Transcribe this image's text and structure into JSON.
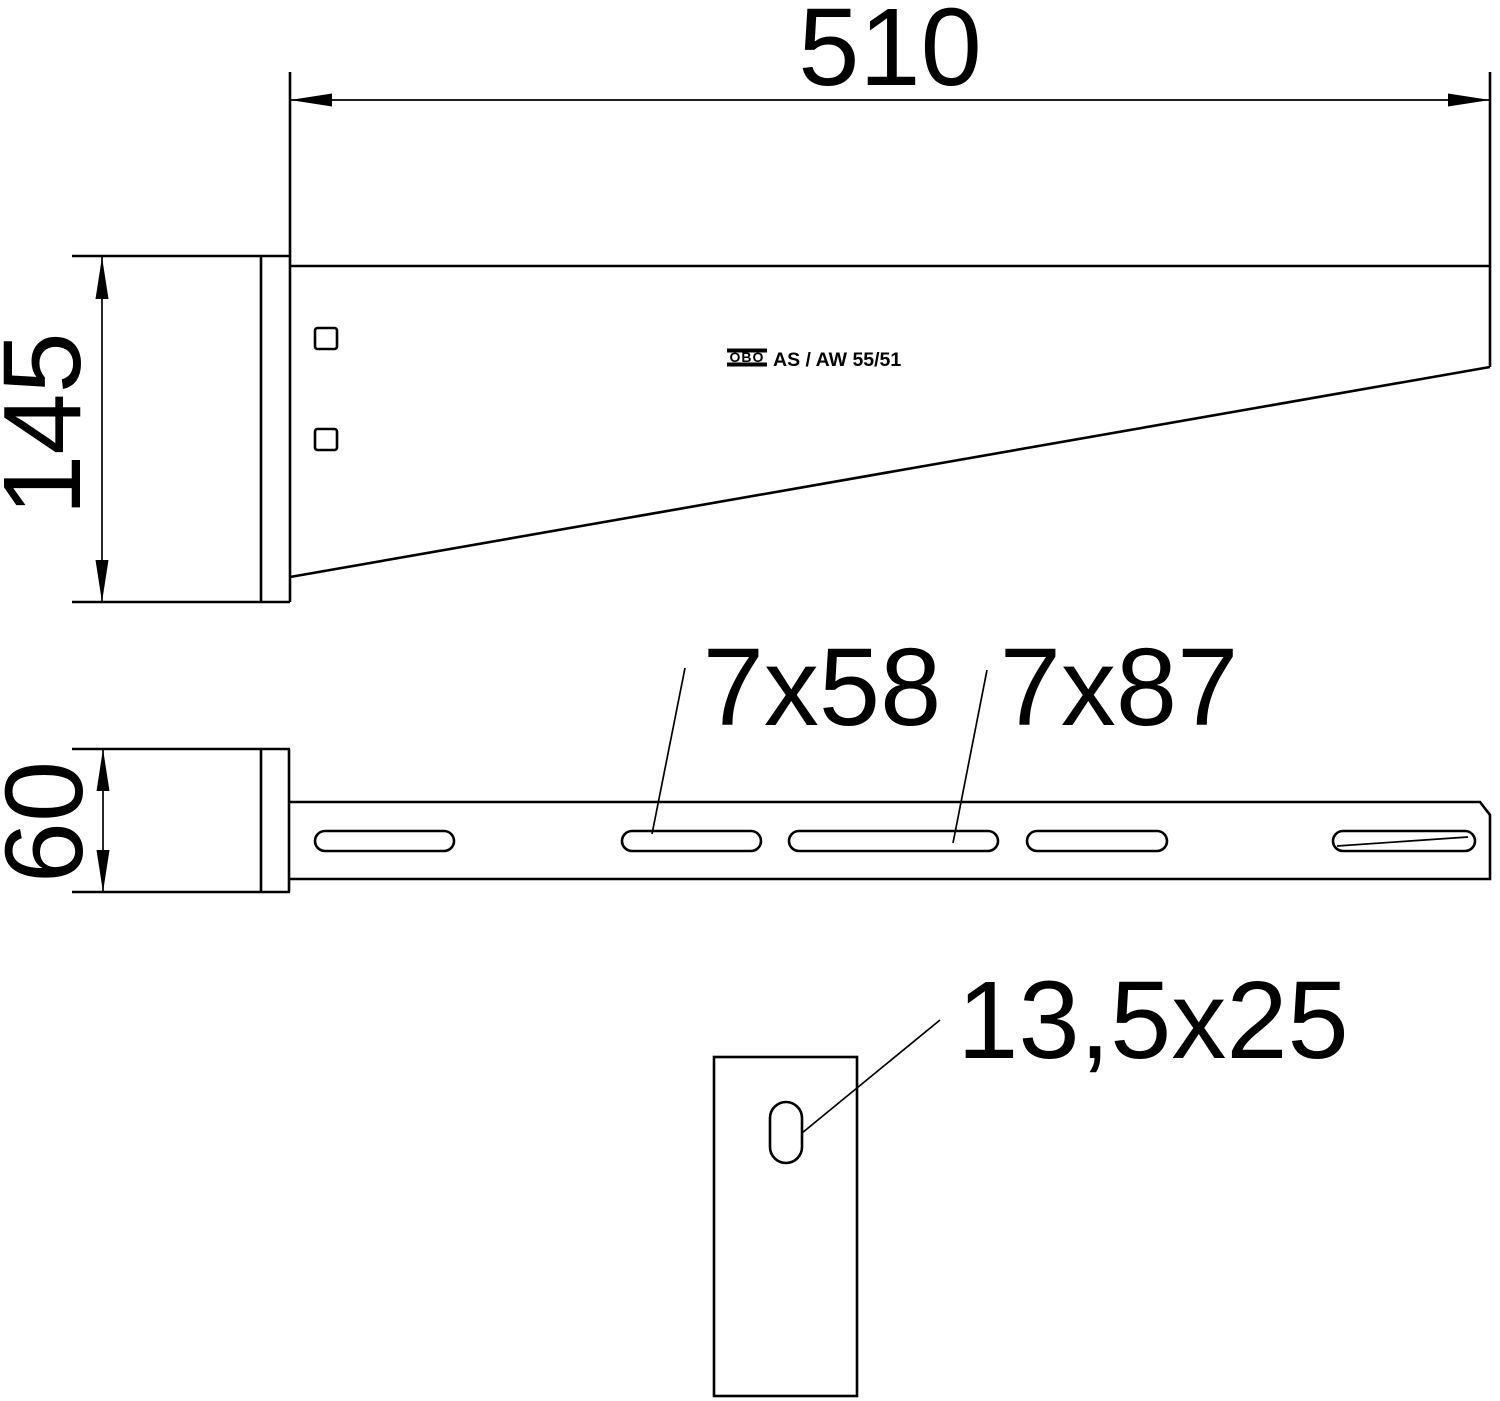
{
  "page": {
    "background": "#ffffff",
    "line_color": "#000000"
  },
  "views": {
    "side_elevation": {
      "width_dim_label": "510",
      "height_dim_label": "145",
      "branding": {
        "logo_text": "OBO",
        "model_text": "AS / AW 55/51"
      }
    },
    "plan_view": {
      "width_dim_label": "60",
      "short_slot_label": "7x58",
      "long_slot_label": "7x87"
    },
    "end_plate_view": {
      "slot_label": "13,5x25"
    }
  }
}
